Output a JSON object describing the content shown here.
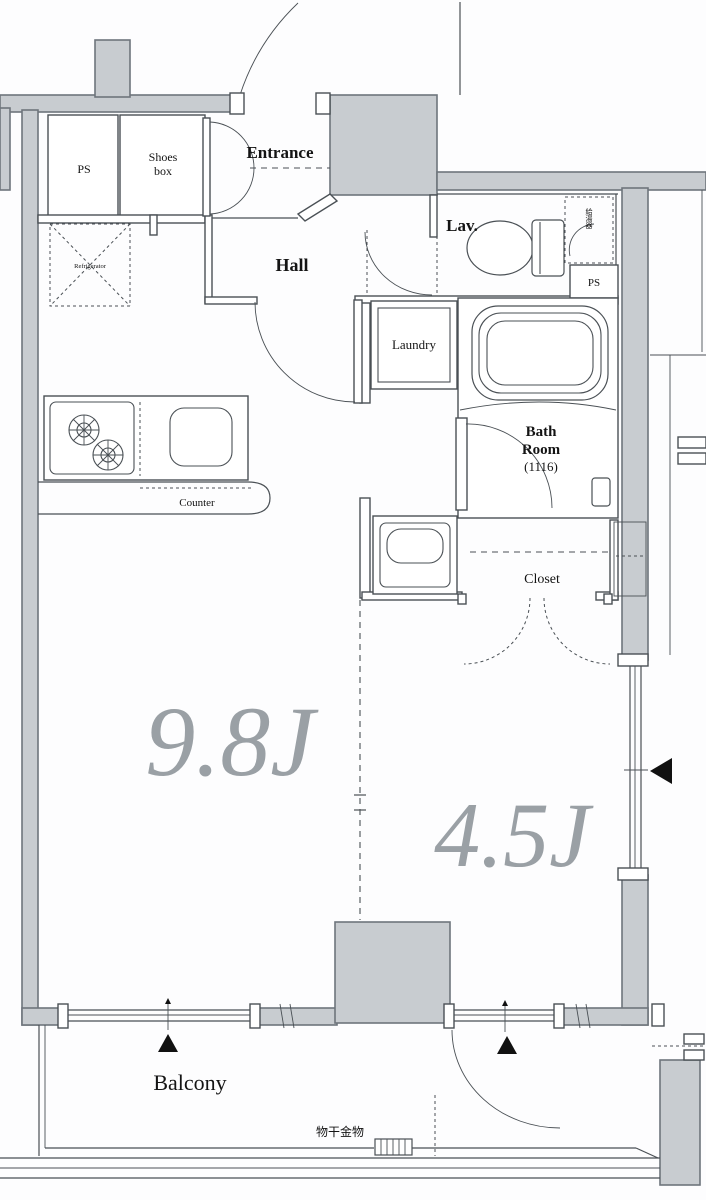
{
  "plan": {
    "type": "apartment-floor-plan",
    "labels": {
      "entrance": "Entrance",
      "ps_top_left": "PS",
      "shoes_box_1": "Shoes",
      "shoes_box_2": "box",
      "hall": "Hall",
      "lav": "Lav.",
      "water_heater": "給湯器",
      "ps_right": "PS",
      "refrigerator": "Refrigerator",
      "laundry": "Laundry",
      "bath_1": "Bath",
      "bath_2": "Room",
      "bath_3": "(1116)",
      "closet": "Closet",
      "counter": "Counter",
      "main_room_size": "9.8J",
      "second_room_size": "4.5J",
      "balcony": "Balcony",
      "drying_fixture": "物干金物"
    },
    "colors": {
      "wall_fill": "#c8ccd0",
      "wall_stroke": "#6e757c",
      "line": "#4a5055",
      "size_text": "#9aa0a5"
    }
  }
}
